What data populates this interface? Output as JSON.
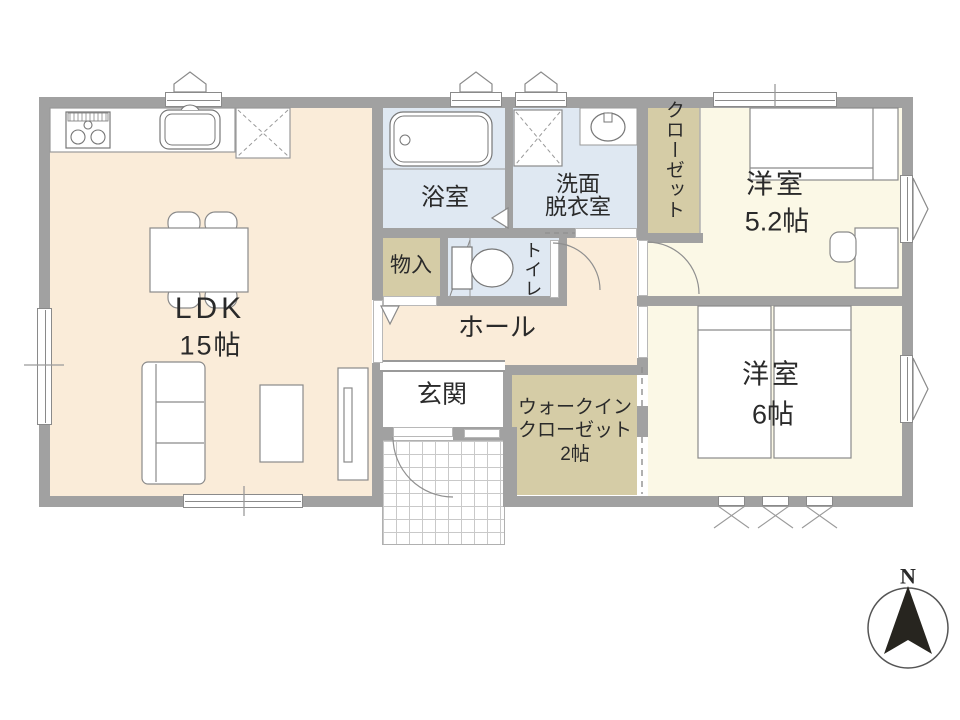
{
  "rooms": {
    "ldk": {
      "label": "LDK",
      "size": "15帖"
    },
    "bath": {
      "label": "浴室"
    },
    "washroom": {
      "line1": "洗面",
      "line2": "脱衣室"
    },
    "closet": {
      "label": "クローゼット"
    },
    "bedroom52": {
      "label": "洋室",
      "size": "5.2帖"
    },
    "storage": {
      "label": "物入"
    },
    "toilet": {
      "label": "トイレ"
    },
    "hall": {
      "label": "ホール"
    },
    "entrance": {
      "label": "玄関"
    },
    "wic": {
      "line1": "ウォークイン",
      "line2": "クローゼット",
      "line3": "2帖"
    },
    "bedroom6": {
      "label": "洋室",
      "size": "6帖"
    }
  },
  "compass": {
    "label": "N"
  },
  "colors": {
    "ldk_floor": "#faecd9",
    "bedroom_floor": "#fbf8e6",
    "wet_area_floor": "#dfe8f2",
    "closet_floor": "#d5cca6",
    "wall": "#a1a1a1",
    "outline": "#8a8a8a",
    "compass_arrow": "#27251f",
    "porch_grid": "#c9c9c9"
  }
}
